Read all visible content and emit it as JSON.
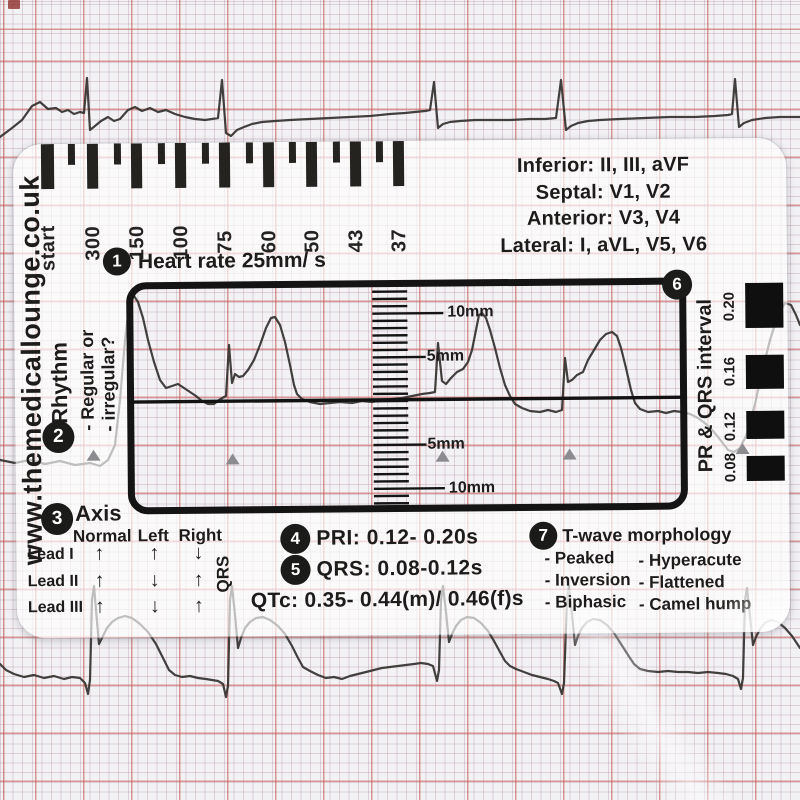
{
  "colors": {
    "card_ink": "#1d1c1a",
    "grid_major_red": "#c65c56",
    "grid_fine": "#a88296",
    "trace": "#33312e",
    "card_tint": "rgba(255,255,255,0.66)"
  },
  "brand": {
    "website": "www.themedicallounge.co.uk"
  },
  "top_ruler": {
    "unit_note": "Heart rate 25mm/ s",
    "labels": [
      "start",
      "300",
      "150",
      "100",
      "75",
      "60",
      "50",
      "43",
      "37"
    ]
  },
  "lead_groups": {
    "lines": [
      "Inferior: II, III, aVF",
      "Septal: V1, V2",
      "Anterior: V3, V4",
      "Lateral: I, aVL, V5, V6"
    ]
  },
  "steps": {
    "s1": {
      "num": "1",
      "label": "Heart rate 25mm/ s"
    },
    "s2": {
      "num": "2",
      "label": "Rhythm",
      "line1": "- Regular or",
      "line2": "- irregular?"
    },
    "s3": {
      "num": "3",
      "label": "Axis",
      "headers": [
        "Normal",
        "Left",
        "Right"
      ],
      "rows": [
        {
          "lead": "Lead I",
          "a": [
            "↑",
            "↑",
            "↓"
          ]
        },
        {
          "lead": "Lead II",
          "a": [
            "↑",
            "↓",
            "↑"
          ]
        },
        {
          "lead": "Lead III",
          "a": [
            "↑",
            "↓",
            "↑"
          ]
        }
      ],
      "qrs": "QRS"
    },
    "s4": {
      "num": "4",
      "label": "PRI: 0.12- 0.20s"
    },
    "s5": {
      "num": "5",
      "label": "QRS: 0.08-0.12s"
    },
    "s6": {
      "num": "6",
      "side_label": "PR & QRS interval",
      "scale": [
        "0.20",
        "0.16",
        "0.12",
        "0.08"
      ]
    },
    "s7": {
      "num": "7",
      "label": "T-wave morphology",
      "col1": [
        "- Peaked",
        "- Inversion",
        "- Biphasic"
      ],
      "col2": [
        "- Hyperacute",
        "- Flattened",
        "- Camel hump"
      ]
    }
  },
  "qtc": "QTc: 0.35- 0.44(m)/ 0.46(f)s",
  "window_scale": {
    "labels": [
      "10mm",
      "5mm",
      "5mm",
      "10mm"
    ]
  }
}
